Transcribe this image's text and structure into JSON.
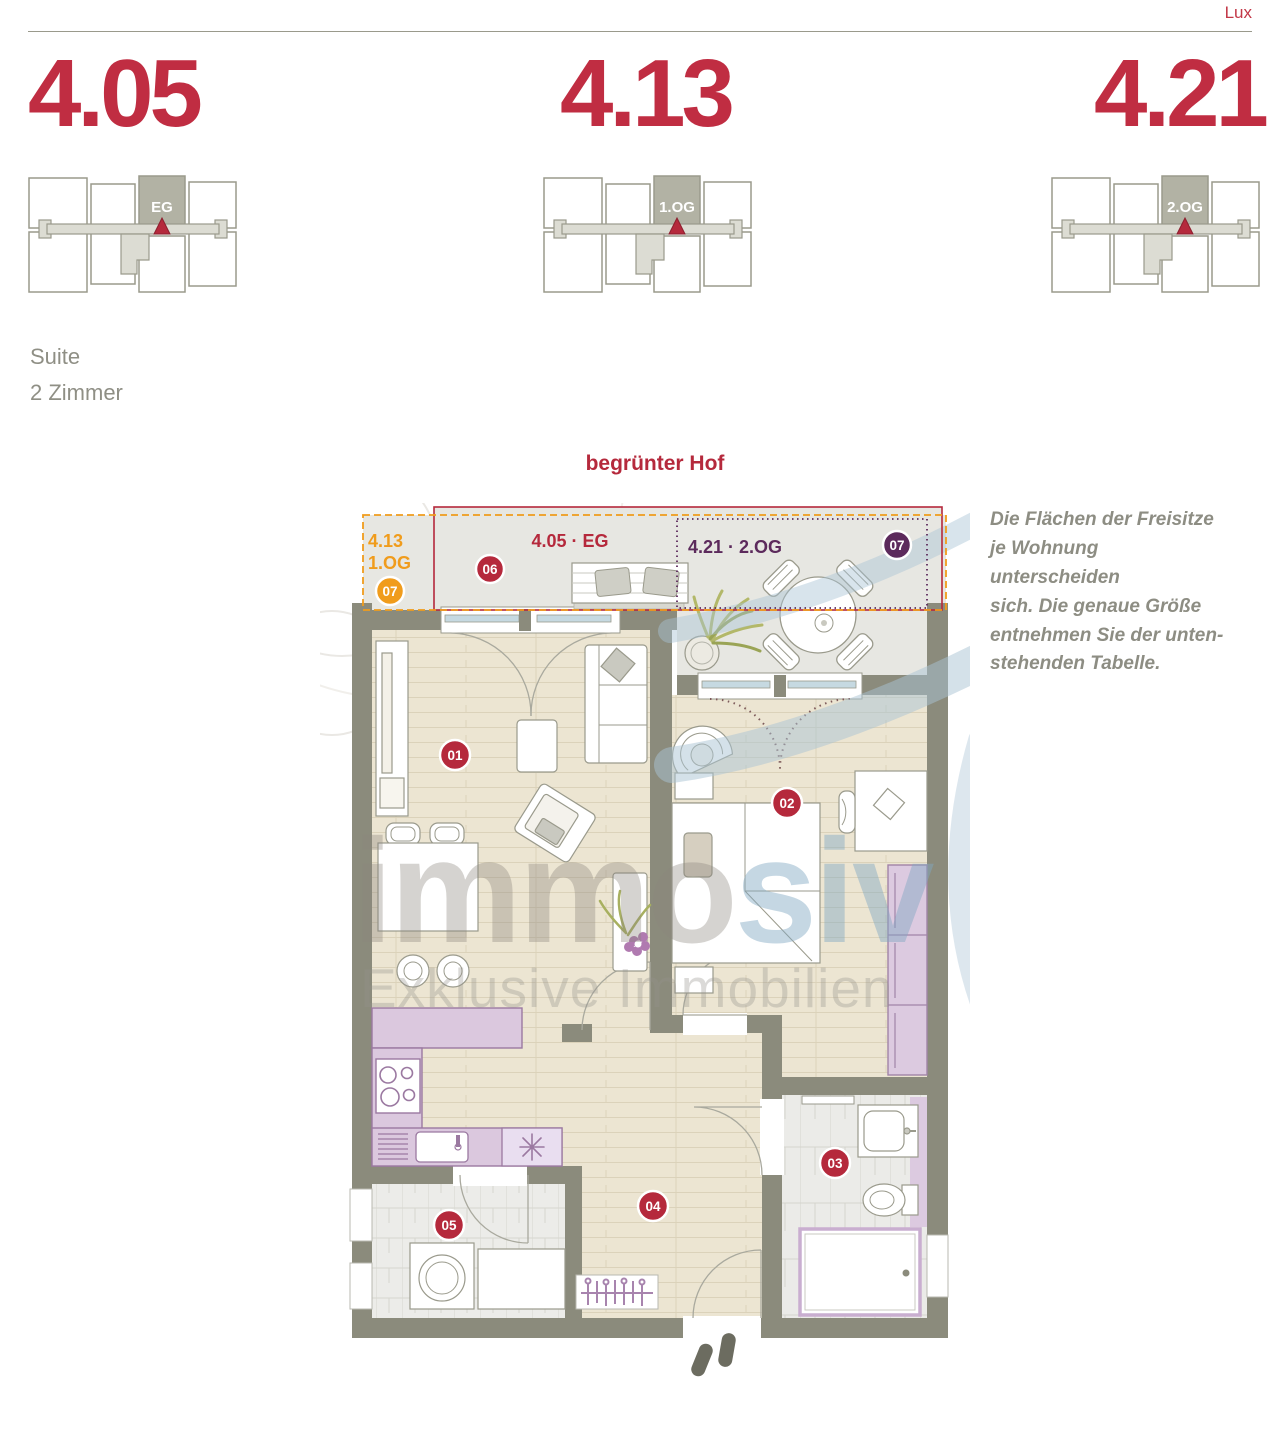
{
  "page": {
    "brand": "Lux"
  },
  "units": [
    {
      "number": "4.05",
      "floor": "EG"
    },
    {
      "number": "4.13",
      "floor": "1.OG"
    },
    {
      "number": "4.21",
      "floor": "2.OG"
    }
  ],
  "apartment": {
    "type": "Suite",
    "rooms": "2 Zimmer"
  },
  "plan": {
    "courtyard_label": "begrünter Hof",
    "terraces": {
      "orange": {
        "line1": "4.13",
        "line2": "1.OG",
        "badge": "07",
        "color": "#f09c1c"
      },
      "red": {
        "label": "4.05 · EG",
        "badge": "06",
        "color": "#b5293c"
      },
      "purple": {
        "label": "4.21 · 2.OG",
        "badge": "07",
        "color": "#5c2a5c"
      }
    },
    "room_badges": [
      "01",
      "02",
      "03",
      "04",
      "05"
    ]
  },
  "note": {
    "lines": [
      "Die Flächen der Freisitze",
      "je Wohnung unterscheiden",
      "sich. Die genaue Größe",
      "entnehmen Sie der unten-",
      "stehenden Tabelle."
    ]
  },
  "watermark": {
    "part1": "immo",
    "part2": "siv",
    "subtitle": "Exklusive Immobilien"
  },
  "colors": {
    "accent_red": "#c02d42",
    "label_red": "#b5293c",
    "orange": "#f09c1c",
    "purple": "#5c2a5c",
    "wall": "#8b8b7c",
    "swoosh_blue": "#a9c4d4"
  }
}
